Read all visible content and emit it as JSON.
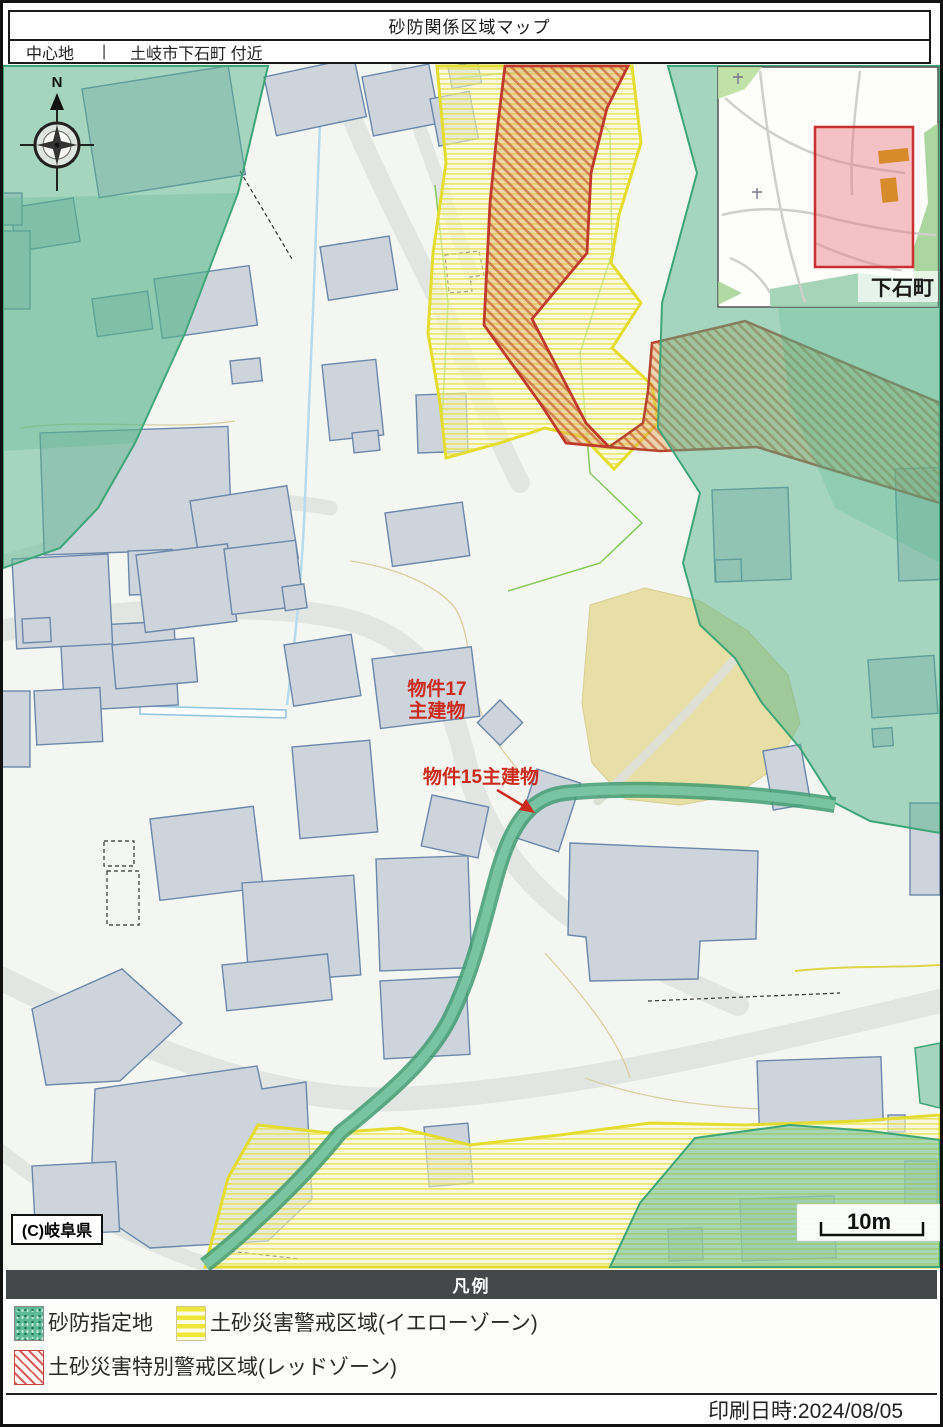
{
  "header": {
    "title": "砂防関係区域マップ",
    "center_label": "中心地",
    "divider": "|",
    "center_value": "土岐市下石町 付近"
  },
  "map": {
    "compass_n": "N",
    "property17_label_line1": "物件17",
    "property17_label_line2": "主建物",
    "property15_label": "物件15主建物",
    "copyright": "(C)岐阜県",
    "scale_label": "10m",
    "inset_town_label": "下石町"
  },
  "legend": {
    "title": "凡例",
    "items": [
      {
        "label": "砂防指定地",
        "swatch": "green-stipple"
      },
      {
        "label": "土砂災害警戒区域(イエローゾーン)",
        "swatch": "yellow-stripe"
      },
      {
        "label": "土砂災害特別警戒区域(レッドゾーン)",
        "swatch": "red-hatch"
      }
    ]
  },
  "footer": {
    "printed_at": "印刷日時:2024/08/05"
  },
  "colors": {
    "sabo_green": "#58b389",
    "yellow_zone_border": "#e4dc2e",
    "red_zone_border": "#c0392b",
    "label_red": "#cc2a1e",
    "legend_bar": "#45484a",
    "inset_highlight": "#cc2f2f"
  }
}
